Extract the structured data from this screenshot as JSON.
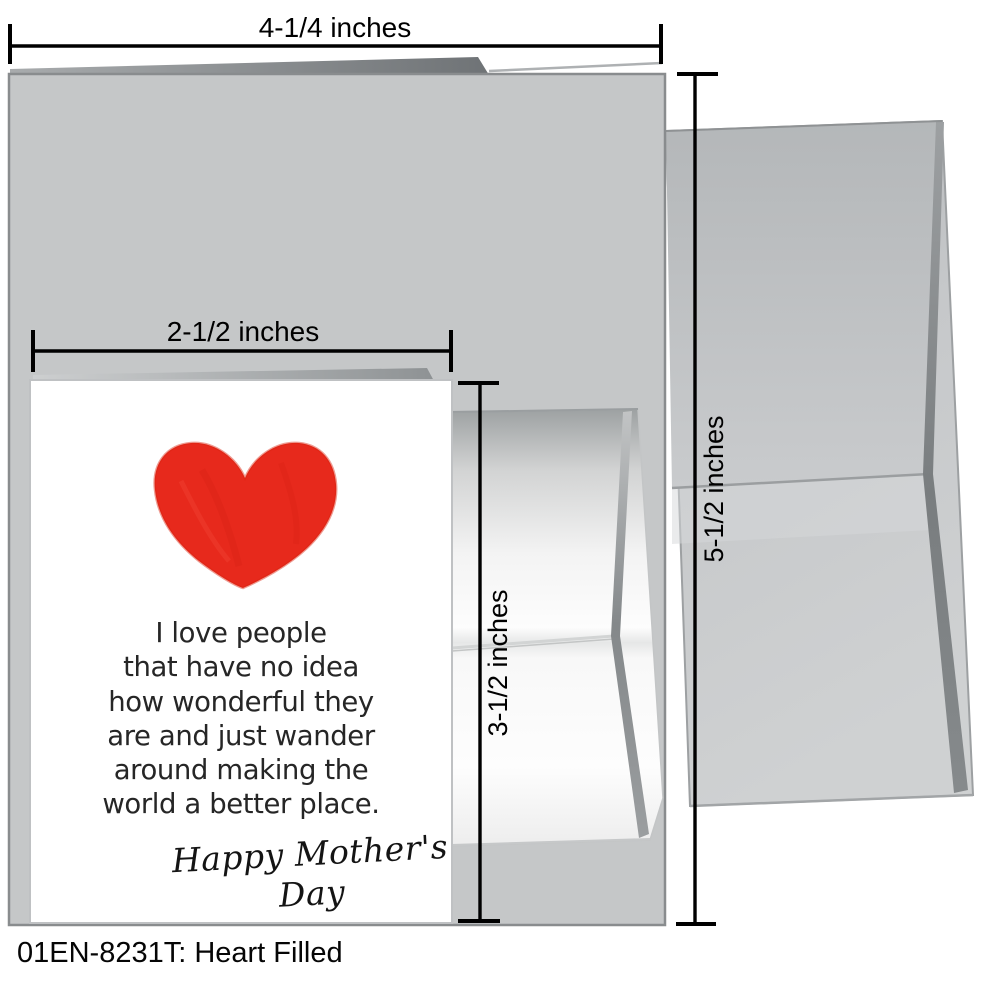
{
  "scene": {
    "caption": "01EN-8231T: Heart Filled",
    "description": "greeting card with envelopes product mockup"
  },
  "measurements": {
    "outer_card_width": "4-1/4 inches",
    "mini_card_width": "2-1/2 inches",
    "mini_card_height": "3-1/2 inches",
    "envelope_height": "5-1/2 inches"
  },
  "mini_card": {
    "message_lines": [
      "I love people",
      "that have no idea",
      "how wonderful they",
      "are and just wander",
      "around making the",
      "world a better place."
    ],
    "signature": "Happy Mother's Day"
  },
  "icons": {
    "heart": "hand-drawn-red-heart"
  },
  "colors": {
    "heart_red": "#e7291c",
    "card_gray": "#c5c7c8",
    "envelope_gray": "#c6c8ca",
    "mini_card_white": "#ffffff",
    "dimension_black": "#000000"
  }
}
